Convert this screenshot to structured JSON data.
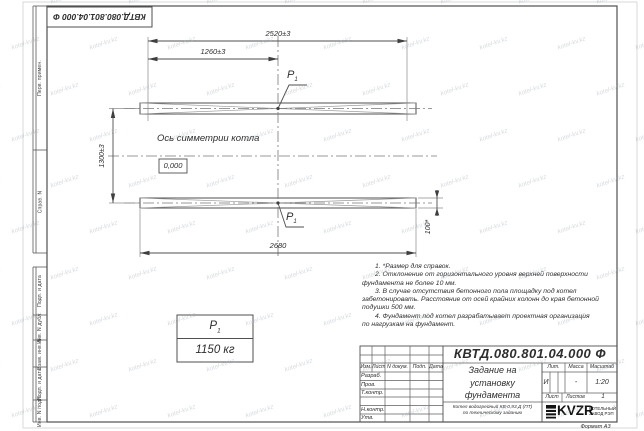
{
  "sheet": {
    "code": "КВТД.080.801.04.000 Ф",
    "format_label": "Формат А3"
  },
  "watermark": {
    "text": "kotel-kv.kz"
  },
  "stamp_strip": {
    "labels": [
      "Перв. примен.",
      "Справ. N",
      "Подп. и дата",
      "Инв. N дубл.",
      "Взам. инв. N",
      "Подп. и дата",
      "Инв. N подл."
    ]
  },
  "drawing": {
    "dim_top": "2520±3",
    "dim_half": "1260±3",
    "dim_vertical": "1300±3",
    "dim_bottom": "2680",
    "dim_height": "100*",
    "axis_label": "Ось симметрии котла",
    "elevation_mark": "0,000",
    "load_symbol": "P",
    "load_index": "1",
    "load_value": "1150 кг"
  },
  "notes": {
    "lines": [
      "1. *Размер для справок.",
      "2. Отклонение от горизонтального уровня верхней поверхности",
      "фундамента не более 10 мм.",
      "3. В случае отсутствия бетонного пола площадку под котел",
      "забетонировать. Расстояние от осей крайних колонн до края бетонной",
      "подушки 500 мм.",
      "4. Фундамент под котел разрабатывает проектная организация",
      "по нагрузкам на фундамент."
    ]
  },
  "titleblock": {
    "doc_number": "КВТД.080.801.04.000 Ф",
    "title_lines": [
      "Задание на",
      "установку",
      "фундамента"
    ],
    "subtitle_lines": [
      "Котел водогрейный КВ-0,93 Д (ПТ)",
      "по техническому заданию"
    ],
    "columns": {
      "izm": "Изм.",
      "list": "Лист",
      "ndoc": "N докум.",
      "podp": "Подп.",
      "data": "Дата"
    },
    "rows": {
      "razrab": "Разраб.",
      "prov": "Пров.",
      "tkontr": "Т.контр.",
      "nkontr": "Н.контр.",
      "utv": "Утв."
    },
    "lit_header": "Лит.",
    "mass_header": "Масса",
    "scale_header": "Масштаб",
    "lit_value": "И",
    "mass_value": "-",
    "scale_value": "1:20",
    "sheet_label": "Лист",
    "sheets_label": "Листов",
    "sheets_value": "1",
    "logo_text": "KVZR",
    "logo_sub1": "КОТЕЛЬНЫЙ",
    "logo_sub2": "ЗАВОД РЭП"
  }
}
